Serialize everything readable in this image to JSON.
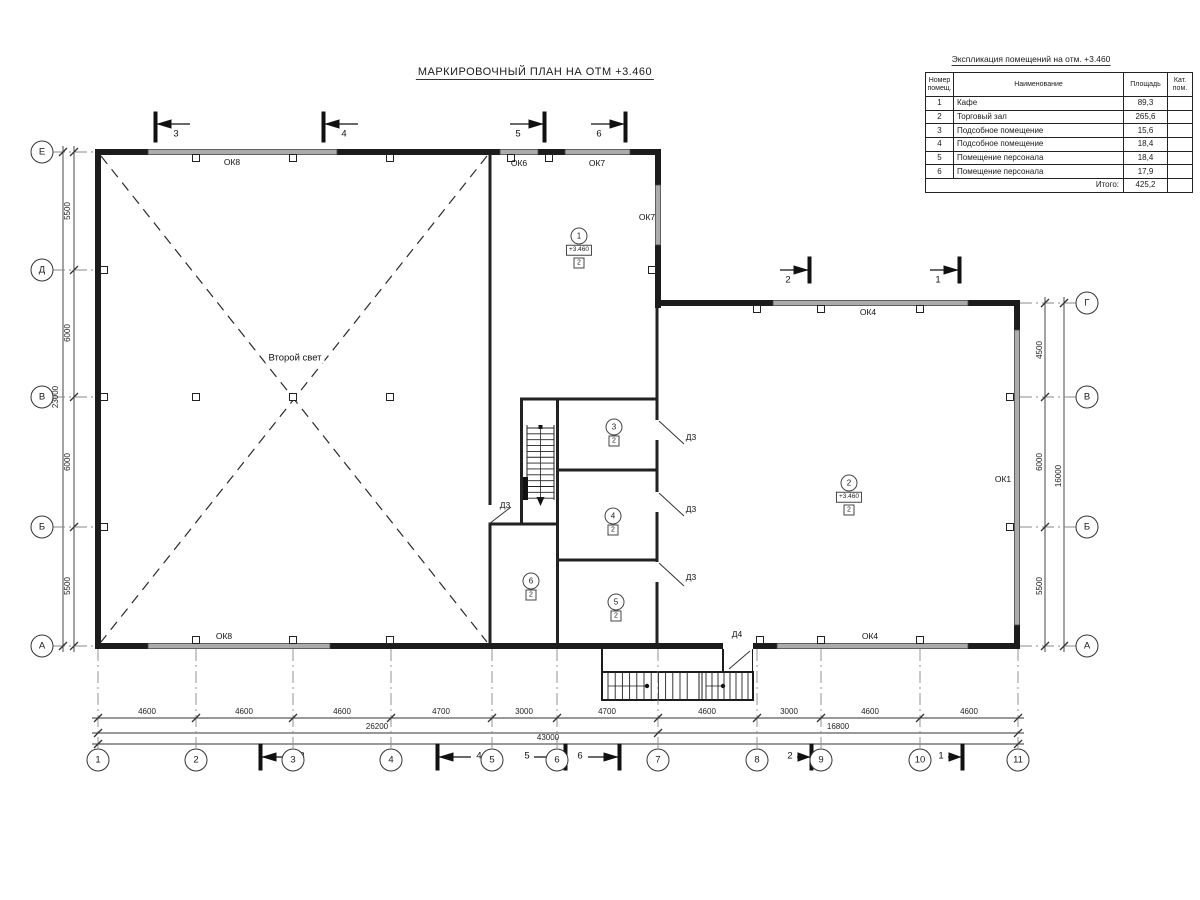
{
  "title": "МАРКИРОВОЧНЫЙ ПЛАН НА ОТМ +3.460",
  "explication": {
    "title": "Экспликация помещений на отм. +3.460",
    "columns": [
      "Номер помещ.",
      "Наименование",
      "Площадь",
      "Кат. пом."
    ],
    "rows": [
      [
        "1",
        "Кафе",
        "89,3",
        ""
      ],
      [
        "2",
        "Торговый зал",
        "265,6",
        ""
      ],
      [
        "3",
        "Подсобное помещение",
        "15,6",
        ""
      ],
      [
        "4",
        "Подсобное помещение",
        "18,4",
        ""
      ],
      [
        "5",
        "Помещение персонала",
        "18,4",
        ""
      ],
      [
        "6",
        "Помещение персонала",
        "17,9",
        ""
      ]
    ],
    "total_label": "Итого:",
    "total_value": "425,2"
  },
  "axes": {
    "bottom": [
      {
        "label": "1",
        "x": 98
      },
      {
        "label": "2",
        "x": 196
      },
      {
        "label": "3",
        "x": 293
      },
      {
        "label": "4",
        "x": 391
      },
      {
        "label": "5",
        "x": 492
      },
      {
        "label": "6",
        "x": 557
      },
      {
        "label": "7",
        "x": 658
      },
      {
        "label": "8",
        "x": 757
      },
      {
        "label": "9",
        "x": 821
      },
      {
        "label": "10",
        "x": 920
      },
      {
        "label": "11",
        "x": 1018
      }
    ],
    "left": [
      {
        "label": "Е",
        "y": 152
      },
      {
        "label": "Д",
        "y": 270
      },
      {
        "label": "В",
        "y": 397
      },
      {
        "label": "Б",
        "y": 527
      },
      {
        "label": "А",
        "y": 646
      }
    ],
    "right": [
      {
        "label": "Г",
        "y": 303
      },
      {
        "label": "В",
        "y": 397
      },
      {
        "label": "Б",
        "y": 527
      },
      {
        "label": "А",
        "y": 646
      }
    ]
  },
  "rooms": [
    {
      "num": "1",
      "elev": "+3.460",
      "cat": "2",
      "x": 579,
      "y": 236
    },
    {
      "num": "2",
      "elev": "+3.460",
      "cat": "2",
      "x": 849,
      "y": 483
    },
    {
      "num": "3",
      "cat": "2",
      "x": 614,
      "y": 427
    },
    {
      "num": "4",
      "cat": "2",
      "x": 613,
      "y": 516
    },
    {
      "num": "5",
      "cat": "2",
      "x": 616,
      "y": 602
    },
    {
      "num": "6",
      "cat": "2",
      "x": 531,
      "y": 581
    }
  ],
  "labels": [
    {
      "t": "ОК8",
      "x": 232,
      "y": 162,
      "cls": "win",
      "name": "window-label-ok8-top"
    },
    {
      "t": "ОК6",
      "x": 519,
      "y": 163,
      "cls": "win",
      "name": "window-label-ok6"
    },
    {
      "t": "ОК7",
      "x": 597,
      "y": 163,
      "cls": "win",
      "name": "window-label-ok7-top"
    },
    {
      "t": "ОК7",
      "x": 647,
      "y": 217,
      "cls": "win",
      "name": "window-label-ok7-right"
    },
    {
      "t": "ОК4",
      "x": 868,
      "y": 312,
      "cls": "win",
      "name": "window-label-ok4-top"
    },
    {
      "t": "ОК1",
      "x": 1003,
      "y": 479,
      "cls": "win",
      "name": "window-label-ok1"
    },
    {
      "t": "ОК8",
      "x": 224,
      "y": 636,
      "cls": "win",
      "name": "window-label-ok8-bottom"
    },
    {
      "t": "ОК4",
      "x": 870,
      "y": 636,
      "cls": "win",
      "name": "window-label-ok4-bottom"
    },
    {
      "t": "Д3",
      "x": 505,
      "y": 505,
      "cls": "door",
      "name": "door-label-d3-hall"
    },
    {
      "t": "Д3",
      "x": 691,
      "y": 437,
      "cls": "door",
      "name": "door-label-d3-room3"
    },
    {
      "t": "Д3",
      "x": 691,
      "y": 509,
      "cls": "door",
      "name": "door-label-d3-room4"
    },
    {
      "t": "Д3",
      "x": 691,
      "y": 577,
      "cls": "door",
      "name": "door-label-d3-room5"
    },
    {
      "t": "Д4",
      "x": 737,
      "y": 634,
      "cls": "door",
      "name": "door-label-d4"
    },
    {
      "t": "Второй свет",
      "x": 295,
      "y": 358,
      "cls": "hall",
      "name": "second-light-label"
    },
    {
      "t": "4600",
      "x": 147,
      "y": 712,
      "cls": "dim"
    },
    {
      "t": "4600",
      "x": 244,
      "y": 712,
      "cls": "dim"
    },
    {
      "t": "4600",
      "x": 342,
      "y": 712,
      "cls": "dim"
    },
    {
      "t": "4700",
      "x": 441,
      "y": 712,
      "cls": "dim"
    },
    {
      "t": "3000",
      "x": 524,
      "y": 712,
      "cls": "dim"
    },
    {
      "t": "4700",
      "x": 607,
      "y": 712,
      "cls": "dim"
    },
    {
      "t": "4600",
      "x": 707,
      "y": 712,
      "cls": "dim"
    },
    {
      "t": "3000",
      "x": 789,
      "y": 712,
      "cls": "dim"
    },
    {
      "t": "4600",
      "x": 870,
      "y": 712,
      "cls": "dim"
    },
    {
      "t": "4600",
      "x": 969,
      "y": 712,
      "cls": "dim"
    },
    {
      "t": "26200",
      "x": 377,
      "y": 727,
      "cls": "dim"
    },
    {
      "t": "16800",
      "x": 838,
      "y": 727,
      "cls": "dim"
    },
    {
      "t": "43000",
      "x": 548,
      "y": 738,
      "cls": "dim"
    },
    {
      "t": "5500",
      "x": 68,
      "y": 211,
      "cls": "dim rot"
    },
    {
      "t": "6000",
      "x": 68,
      "y": 333,
      "cls": "dim rot"
    },
    {
      "t": "6000",
      "x": 68,
      "y": 462,
      "cls": "dim rot"
    },
    {
      "t": "5500",
      "x": 68,
      "y": 586,
      "cls": "dim rot"
    },
    {
      "t": "23000",
      "x": 56,
      "y": 397,
      "cls": "dim rot"
    },
    {
      "t": "4500",
      "x": 1040,
      "y": 350,
      "cls": "dim rot"
    },
    {
      "t": "6000",
      "x": 1040,
      "y": 462,
      "cls": "dim rot"
    },
    {
      "t": "5500",
      "x": 1040,
      "y": 586,
      "cls": "dim rot"
    },
    {
      "t": "16000",
      "x": 1059,
      "y": 476,
      "cls": "dim rot"
    },
    {
      "t": "3",
      "x": 176,
      "y": 134,
      "cls": "sec",
      "name": "section-mark-3-top"
    },
    {
      "t": "4",
      "x": 344,
      "y": 134,
      "cls": "sec",
      "name": "section-mark-4-top"
    },
    {
      "t": "5",
      "x": 518,
      "y": 134,
      "cls": "sec",
      "name": "section-mark-5-top"
    },
    {
      "t": "6",
      "x": 599,
      "y": 134,
      "cls": "sec",
      "name": "section-mark-6-top"
    },
    {
      "t": "2",
      "x": 788,
      "y": 280,
      "cls": "sec",
      "name": "section-mark-2-right"
    },
    {
      "t": "1",
      "x": 938,
      "y": 280,
      "cls": "sec",
      "name": "section-mark-1-right"
    },
    {
      "t": "3",
      "x": 302,
      "y": 756,
      "cls": "sec",
      "name": "section-mark-3-bottom"
    },
    {
      "t": "4",
      "x": 479,
      "y": 756,
      "cls": "sec",
      "name": "section-mark-4-bottom"
    },
    {
      "t": "5",
      "x": 527,
      "y": 756,
      "cls": "sec",
      "name": "section-mark-5-bottom"
    },
    {
      "t": "6",
      "x": 580,
      "y": 756,
      "cls": "sec",
      "name": "section-mark-6-bottom"
    },
    {
      "t": "2",
      "x": 790,
      "y": 756,
      "cls": "sec",
      "name": "section-mark-2-bottom"
    },
    {
      "t": "1",
      "x": 941,
      "y": 756,
      "cls": "sec",
      "name": "section-mark-1-bottom"
    }
  ]
}
